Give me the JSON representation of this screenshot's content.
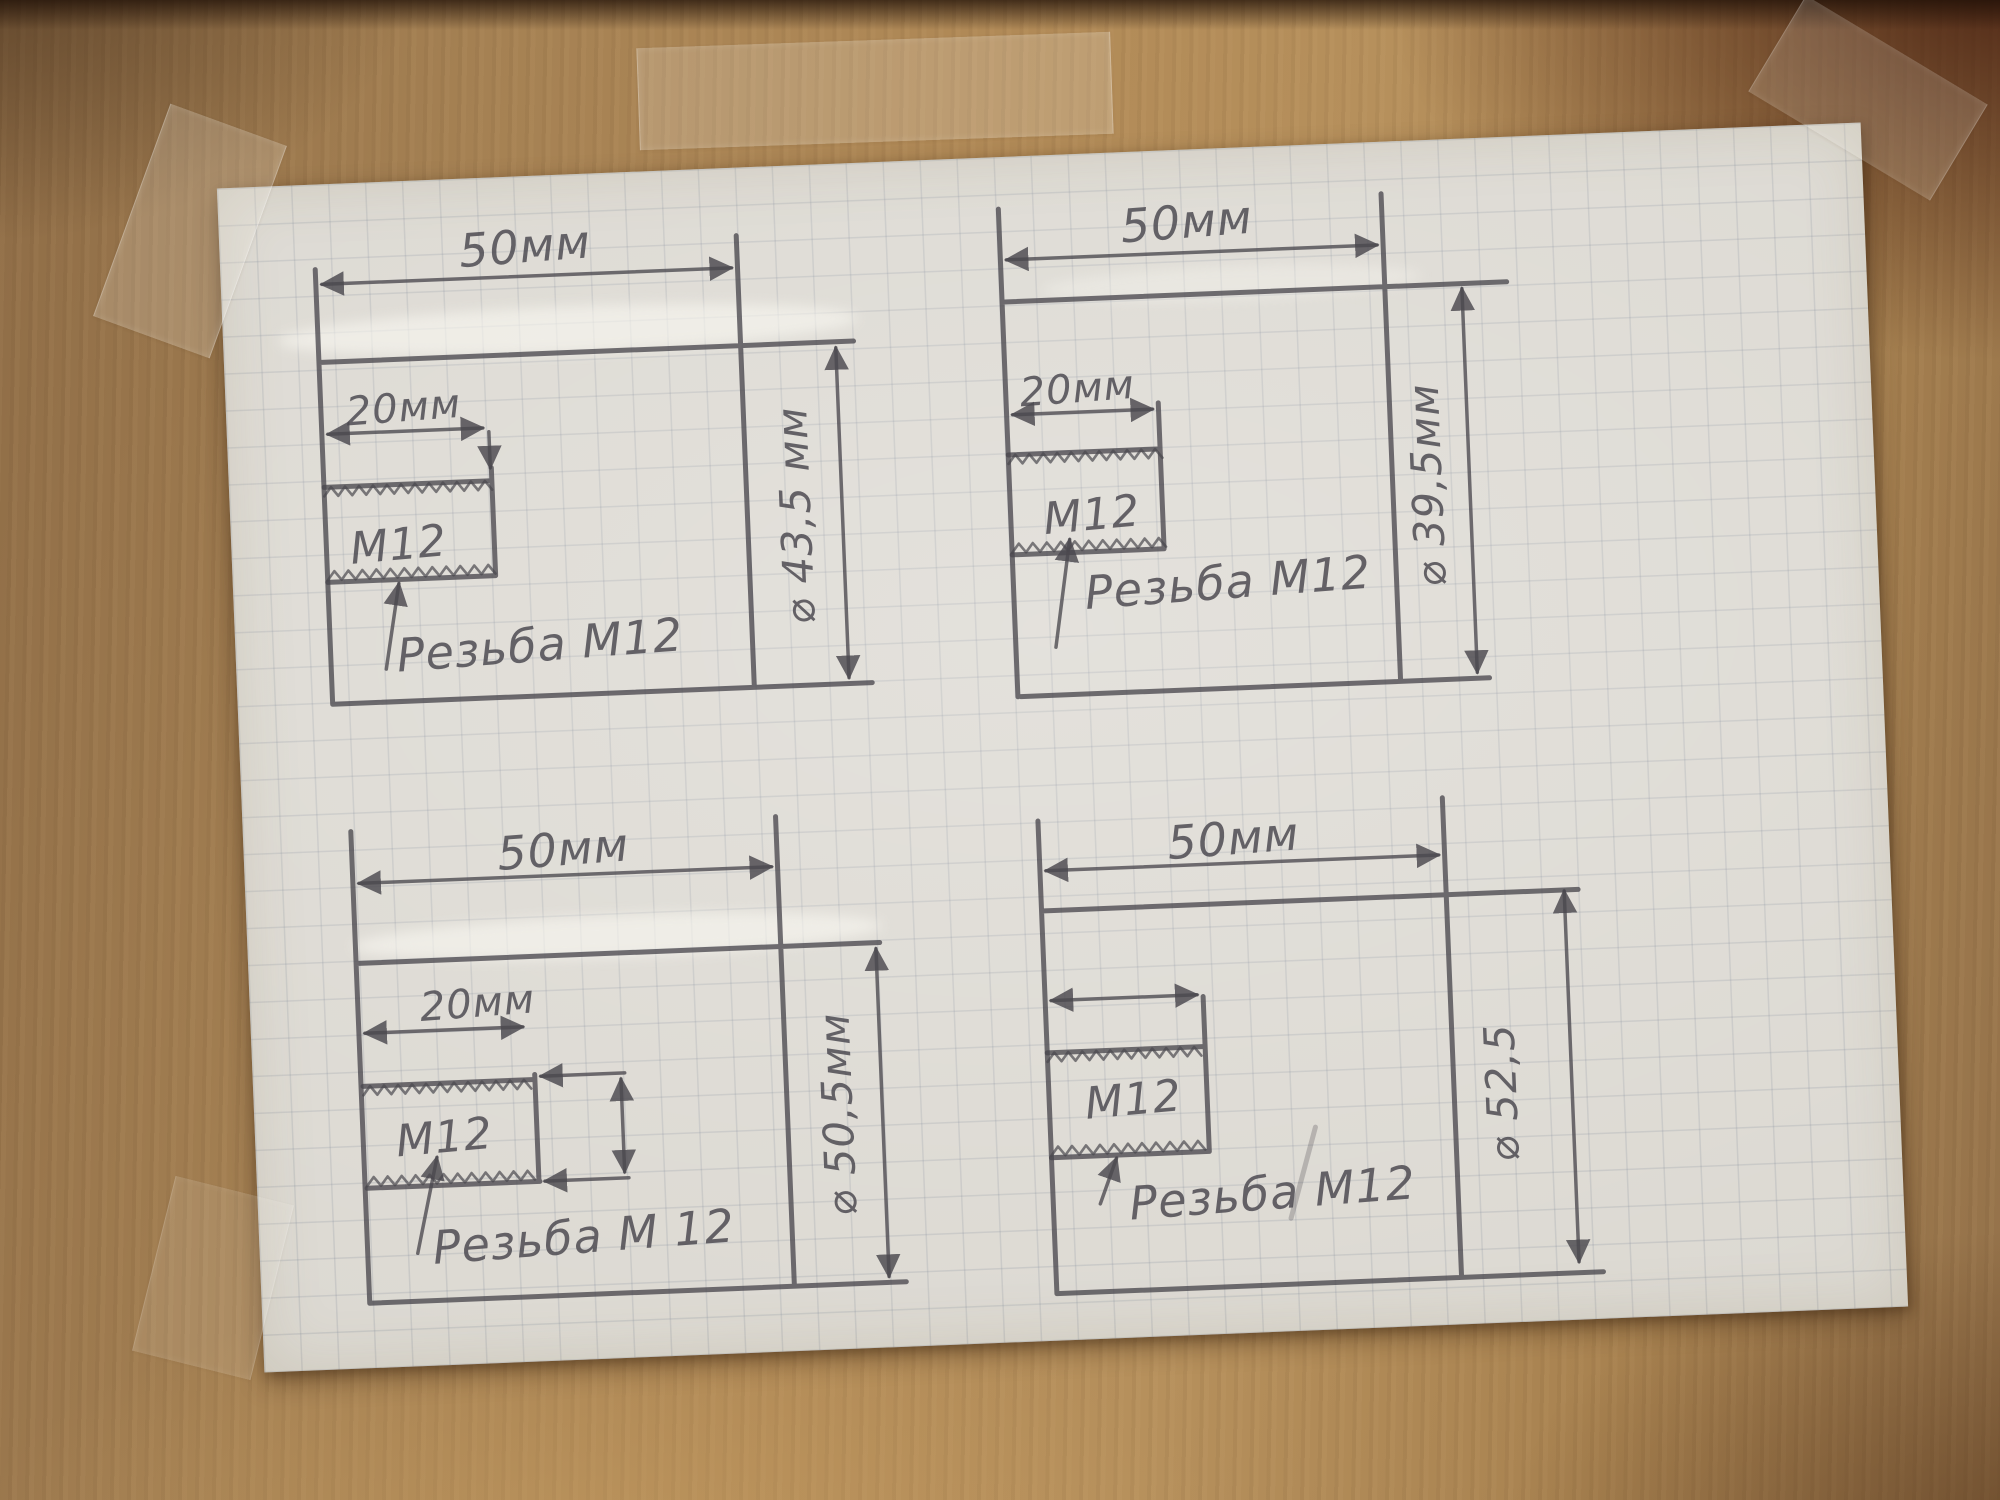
{
  "colors": {
    "pencil": "#4a484e",
    "paper": "#dcd9d2",
    "grid_line": "#7a8294",
    "wood_light": "#b6905c",
    "wood_dark": "#6e5136",
    "tape": "#f2ede2"
  },
  "drawings": [
    {
      "position": "top-left",
      "length_label": "50мм",
      "thread_length_label": "20мм",
      "thread_size_label": "М12",
      "thread_note_label": "Резьба М12",
      "diameter_label": "⌀ 43,5 мм"
    },
    {
      "position": "top-right",
      "length_label": "50мм",
      "thread_length_label": "20мм",
      "thread_size_label": "М12",
      "thread_note_label": "Резьба М12",
      "diameter_label": "⌀ 39,5мм"
    },
    {
      "position": "bottom-left",
      "length_label": "50мм",
      "thread_length_label": "20мм",
      "thread_size_label": "М12",
      "thread_note_label": "Резьба М 12",
      "diameter_label": "⌀ 50,5мм"
    },
    {
      "position": "bottom-right",
      "length_label": "50мм",
      "thread_length_label": "",
      "thread_size_label": "М12",
      "thread_note_label": "Резьба М12",
      "diameter_label": "⌀ 52,5"
    }
  ]
}
